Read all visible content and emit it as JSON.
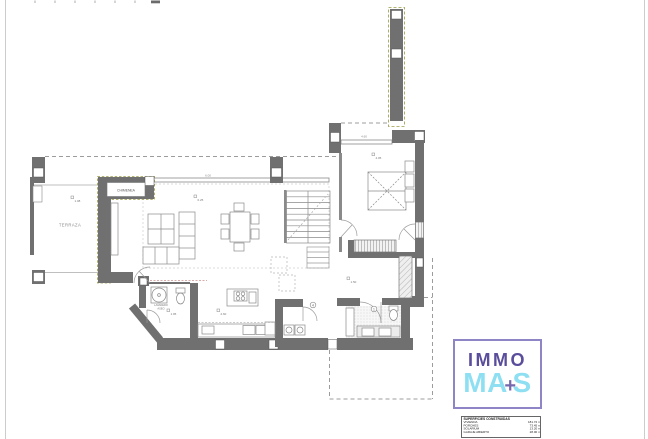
{
  "sheet": {
    "background": "#ffffff",
    "frame_color": "#cccccc"
  },
  "logo": {
    "top_word": "IMMO",
    "bottom_left": "MA",
    "plus": "+",
    "bottom_right": "S",
    "colors": {
      "border": "#8d85c6",
      "top_word": "#5a4d9c",
      "bottom_word": "#8edff2",
      "plus": "#7668ad"
    }
  },
  "areas_table": {
    "title": "SUPERFICIES CONSTRUIDAS",
    "rows": [
      {
        "name": "VIVIENDA",
        "value": "181.72 m²"
      },
      {
        "name": "PORCHES",
        "value": "73.45 m²"
      },
      {
        "name": "SOLARIUM",
        "value": "13.20 m²"
      },
      {
        "name": "GARAJE ABIERTO",
        "value": "28.00 m²"
      }
    ]
  },
  "plan": {
    "labels": {
      "fireplace_box": "CHIMENEA",
      "terrace": "TERRAZA",
      "laundry_note_1": "LAVADERO",
      "laundry_note_2": "ASEO"
    },
    "dimensions": {
      "living_window": "6.00",
      "bedroom_window": "4.60"
    },
    "level_markers": [
      {
        "value": "1.08"
      },
      {
        "value": "0.25"
      },
      {
        "value": "4.05"
      },
      {
        "value": "1.95"
      },
      {
        "value": "2.60"
      },
      {
        "value": "1.50"
      }
    ],
    "key_notes": [
      {
        "n": "4"
      },
      {
        "n": "1"
      }
    ],
    "colors": {
      "wall": "#707070",
      "line": "#8a8a8a",
      "dash_olive": "#9a9a45"
    }
  }
}
